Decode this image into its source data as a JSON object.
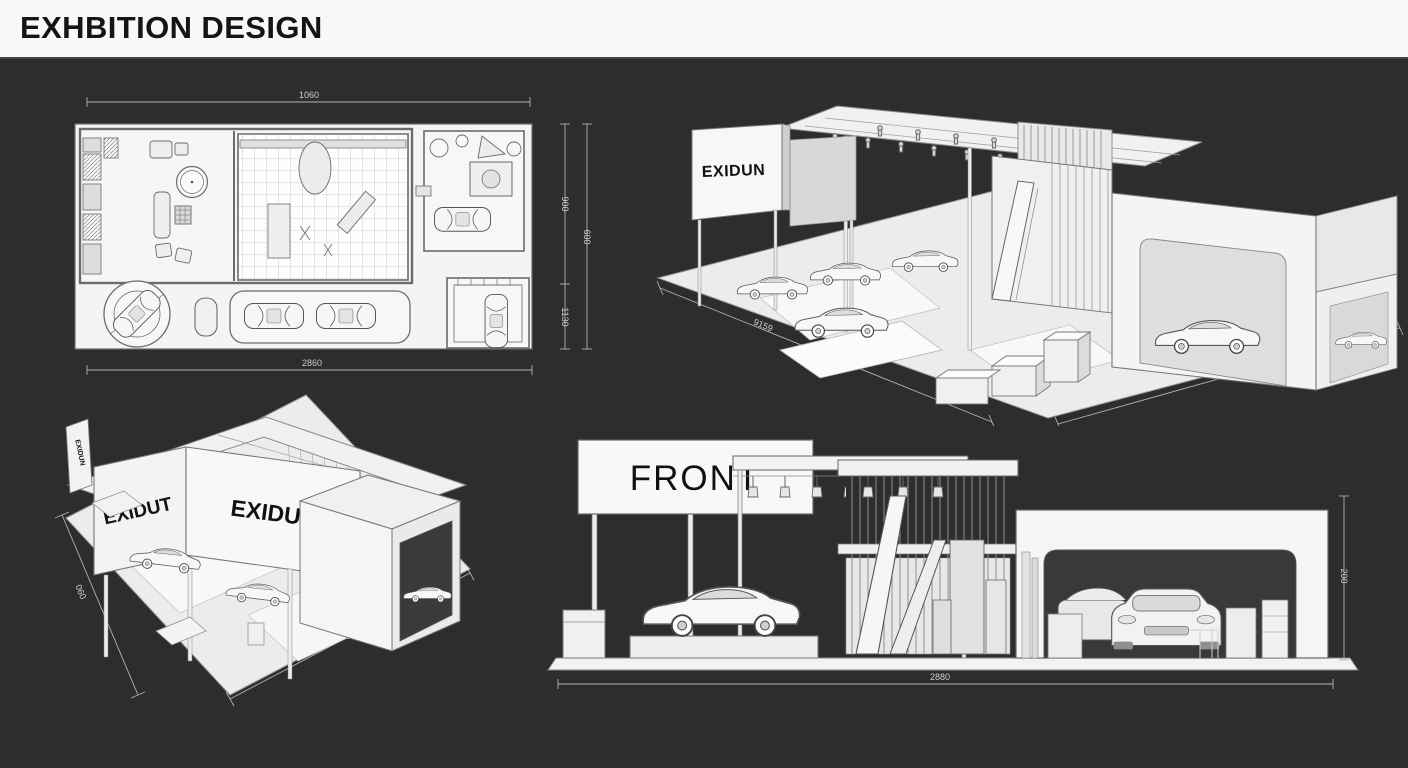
{
  "header": {
    "title": "EXHBITION DESIGN"
  },
  "colors": {
    "background": "#2e2d2e",
    "header_bg": "#f8f8f8",
    "title_text": "#151515",
    "drawing_fill": "#f4f4f4",
    "drawing_line": "#6b6b6b",
    "dimension_line": "#b3b3b3",
    "dimension_text": "#cfcfcf"
  },
  "plan": {
    "caption": "top view floor plan",
    "dims": {
      "top": "1060",
      "bottom": "2860",
      "right_inner_top": "900",
      "right_inner_bottom": "1130",
      "right_outer": "600"
    }
  },
  "iso_top": {
    "logo": "EXIDUN",
    "dims": {
      "left": "9159",
      "right": "700"
    }
  },
  "iso_bottom": {
    "logo_left": "EXIDUT",
    "logo_front": "EXIDUN",
    "logo_side": "EXIDUN",
    "dims": {
      "left": "060",
      "bottom": "0850"
    }
  },
  "front": {
    "label": "FRONT",
    "dims": {
      "bottom": "2880",
      "right": "200"
    }
  }
}
